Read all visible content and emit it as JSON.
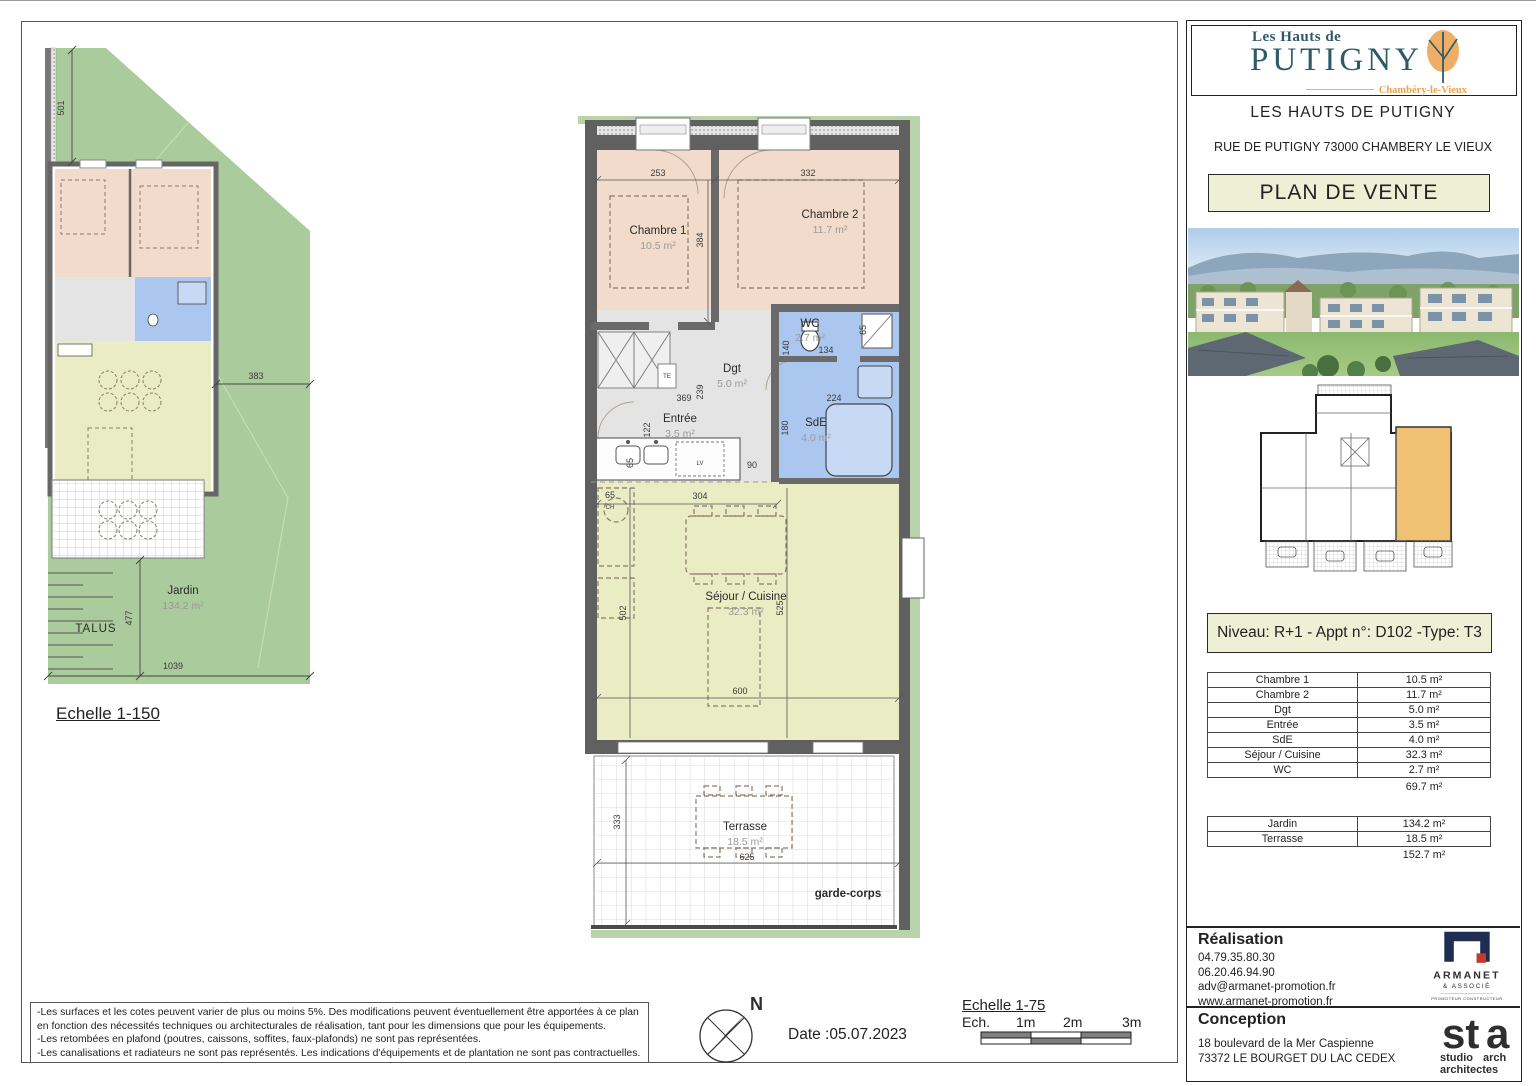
{
  "colors": {
    "accent_box_bg": "#eef0d5",
    "bedroom_pink": "#f2dbca",
    "living_yellow": "#eaecc4",
    "sanitary_blue": "#abc7f0",
    "corridor_grey": "#e4e4e4",
    "garden_green": "#aacb9b",
    "wall_grey": "#606060",
    "logo_teal": "#2d5b68",
    "logo_orange": "#efae66",
    "armanet_navy": "#1f2d50",
    "armanet_red": "#c23b2e",
    "sta_green": "#6cb33f"
  },
  "site_plan": {
    "scale_label": "Echelle 1-150",
    "talus_label": "TALUS",
    "jardin": {
      "name": "Jardin",
      "area": "134.2 m²"
    },
    "dims": {
      "d501": "501",
      "d383": "383",
      "d477": "477",
      "d1039": "1039"
    }
  },
  "main_plan": {
    "rooms": {
      "chambre1": {
        "name": "Chambre 1",
        "area": "10.5 m²"
      },
      "chambre2": {
        "name": "Chambre 2",
        "area": "11.7 m²"
      },
      "wc": {
        "name": "WC",
        "area": "2.7 m²"
      },
      "dgt": {
        "name": "Dgt",
        "area": "5.0 m²"
      },
      "entree": {
        "name": "Entrée",
        "area": "3.5 m²"
      },
      "sde": {
        "name": "SdE",
        "area": "4.0 m²"
      },
      "sejour": {
        "name": "Séjour / Cuisine",
        "area": "32.3 m²"
      },
      "terrasse": {
        "name": "Terrasse",
        "area": "18.5 m²"
      }
    },
    "dims": {
      "d253": "253",
      "d332": "332",
      "d384": "384",
      "d369": "369",
      "d239": "239",
      "d122": "122",
      "d140": "140",
      "d134": "134",
      "d65_wc": "65",
      "d224": "224",
      "d180": "180",
      "d65_kitchen": "65",
      "d90": "90",
      "d65_ch": "65",
      "d304": "304",
      "d502": "502",
      "d525": "525",
      "d600": "600",
      "d333": "333",
      "d625": "625",
      "lv": "LV",
      "ch": "CH",
      "te": "TE"
    },
    "garde_corps_label": "garde-corps"
  },
  "right_panel": {
    "logo": {
      "line1": "Les Hauts de",
      "brand": "PUTIGNY",
      "subtitle": "Chambéry-le-Vieux"
    },
    "project_name": "LES HAUTS DE PUTIGNY",
    "address": "RUE DE PUTIGNY 73000 CHAMBERY LE VIEUX",
    "doc_title": "PLAN DE VENTE",
    "apartment_info": "Niveau: R+1  - Appt n°: D102 -Type: T3",
    "area_table": {
      "rows": [
        [
          "Chambre 1",
          "10.5 m²"
        ],
        [
          "Chambre 2",
          "11.7 m²"
        ],
        [
          "Dgt",
          "5.0 m²"
        ],
        [
          "Entrée",
          "3.5 m²"
        ],
        [
          "SdE",
          "4.0 m²"
        ],
        [
          "Séjour / Cuisine",
          "32.3 m²"
        ],
        [
          "WC",
          "2.7 m²"
        ]
      ],
      "total": "69.7 m²"
    },
    "exterior_table": {
      "rows": [
        [
          "Jardin",
          "134.2 m²"
        ],
        [
          "Terrasse",
          "18.5 m²"
        ]
      ],
      "total": "152.7 m²"
    },
    "realisation": {
      "title": "Réalisation",
      "phone1": "04.79.35.80.30",
      "phone2": "06.20.46.94.90",
      "email": "adv@armanet-promotion.fr",
      "website": "www.armanet-promotion.fr",
      "logo": {
        "name": "ARMANET",
        "sub": "& ASSOCIÉ",
        "tagline": "PROMOTEUR CONSTRUCTEUR"
      }
    },
    "conception": {
      "title": "Conception",
      "address1": "18 boulevard de la Mer Caspienne",
      "address2": "73372 LE BOURGET DU LAC CEDEX",
      "logo": {
        "name_part1": "st",
        "name_part2": "a",
        "sub1a": "studio ",
        "sub1b": "arch",
        "sub2": "architectes"
      }
    }
  },
  "footer": {
    "disclaimer_lines": [
      "-Les surfaces et les cotes peuvent varier de plus ou moins 5%. Des modifications peuvent éventuellement être apportées à ce plan en fonction des nécessités techniques ou architecturales de réalisation, tant pour les dimensions que pour les équipements.",
      "-Les retombées en plafond (poutres, caissons, soffites, faux-plafonds) ne sont pas représentées.",
      "-Les canalisations et radiateurs ne sont pas représentés. Les indications d'équipements et de plantation ne sont pas contractuelles."
    ],
    "compass_label": "N",
    "date_label": "Date :05.07.2023",
    "scale_title": "Echelle 1-75",
    "scale_ticks": [
      "Ech.",
      "1m",
      "2m",
      "3m"
    ]
  }
}
